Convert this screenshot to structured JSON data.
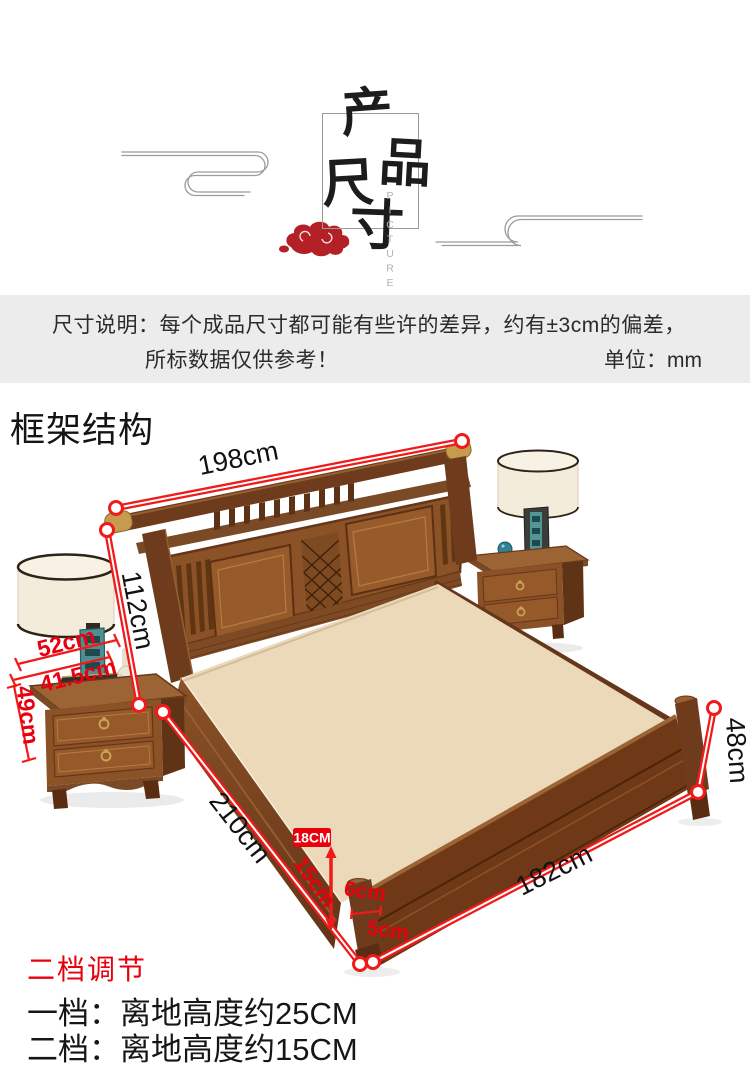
{
  "header": {
    "logo_chars": {
      "c1": "产",
      "c2": "品",
      "c3": "尺",
      "c4": "寸"
    },
    "logo_caption": "PICTURE"
  },
  "notice": {
    "line1": "尺寸说明：每个成品尺寸都可能有些许的差异，约有±3cm的偏差，",
    "line2": "所标数据仅供参考！",
    "unit_label": "单位：mm"
  },
  "section": {
    "title": "框架结构"
  },
  "dimensions": {
    "headboard_width": "198cm",
    "headboard_height": "112cm",
    "nightstand_width": "52cm",
    "nightstand_depth": "41.5cm",
    "nightstand_height": "49cm",
    "bed_length": "210cm",
    "bed_width": "182cm",
    "footboard_height": "48cm",
    "clearance_first": "18CM",
    "clearance_second": "15cm",
    "leg_width": "6cm",
    "leg_thickness": "5cm"
  },
  "adjustment": {
    "title": "二档调节",
    "level1": "一档：离地高度约25CM",
    "level2": "二档：离地高度约15CM"
  },
  "colors": {
    "accent_red": "#e8000d",
    "cloud_red": "#b32025",
    "wood_dark": "#6e3c1d",
    "wood_mid": "#8a5226",
    "wood_light": "#9c6434",
    "platform_cream": "#ebd9ba",
    "band_gray": "#ececec",
    "brass": "#c69b4e",
    "lamp_teal": "#4f8f93",
    "label_black": "#111111"
  }
}
